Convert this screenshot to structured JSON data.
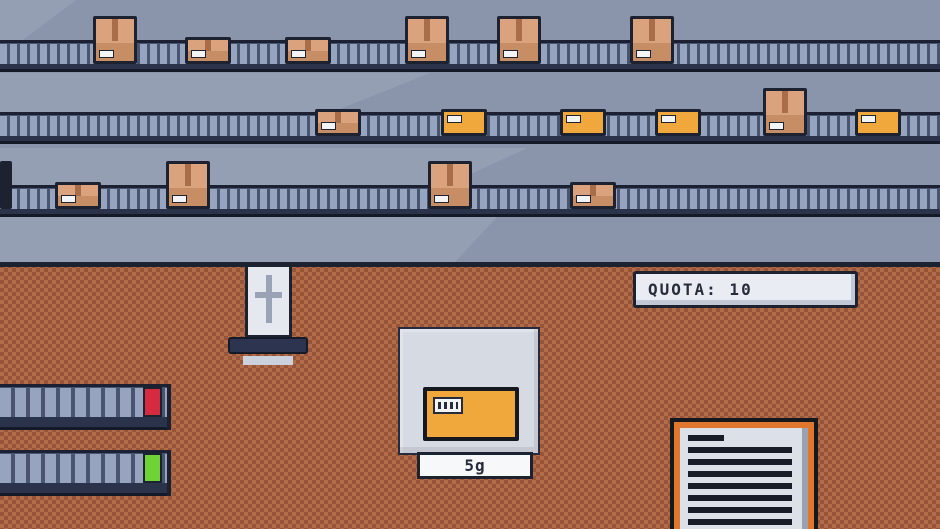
{
  "hud": {
    "quota_sign": {
      "label": "QUOTA: 10"
    },
    "scale_display": {
      "value": "5g"
    }
  },
  "colors": {
    "wall": "#8a95ab",
    "shaft": "rgba(255,255,255,0.10)",
    "outline": "#1d2231",
    "beltSlat": "#97a4bf",
    "beltGap": "#49546e",
    "beltTopLine": "#1b2133",
    "beltBand": "#2a3349",
    "beltBandEdge": "#151a28",
    "floorA": "#b26c47",
    "floorB": "#96553a",
    "boxBrownTop": "#daa37d",
    "boxBrownBottom": "#c78e66",
    "boxTape": "#aa6d4a",
    "boxYellow": "#f0a83c",
    "label": "#f2f4f6",
    "red": "#d62b3e",
    "green": "#6fd335",
    "signBg": "#e9edf3",
    "signShade": "#c2c8d5",
    "signText": "#272c3a",
    "platform": "#d6dae2",
    "platformEdge": "#262c3e",
    "pistonRod": "#e5e9ef",
    "pistonMark": "#9aa3b6",
    "pistonBar": "#2c3450",
    "pistonFoot": "#ccd2dd",
    "clipOrange": "#e0772c",
    "paper": "#dce0e8",
    "paperLine": "#181c28",
    "paperEdge": "#9aa2b2",
    "displayBg": "#f6f8fa",
    "darkBoxEdge": "#15181f"
  },
  "box_types": {
    "tall-brown": {
      "w": 44,
      "h": 48
    },
    "wide-brown": {
      "w": 46,
      "h": 27
    },
    "yellow": {
      "w": 46,
      "h": 27
    },
    "edge-dark": {
      "w": 12,
      "h": 48
    }
  },
  "belts": [
    {
      "name": "conveyor-belt-top",
      "surface_y": 64,
      "boxes": [
        {
          "type": "tall-brown",
          "x": 93
        },
        {
          "type": "wide-brown",
          "x": 185
        },
        {
          "type": "wide-brown",
          "x": 285
        },
        {
          "type": "tall-brown",
          "x": 405
        },
        {
          "type": "tall-brown",
          "x": 497
        },
        {
          "type": "tall-brown",
          "x": 630
        }
      ]
    },
    {
      "name": "conveyor-belt-middle",
      "surface_y": 136,
      "boxes": [
        {
          "type": "wide-brown",
          "x": 315
        },
        {
          "type": "yellow",
          "x": 441
        },
        {
          "type": "yellow",
          "x": 560
        },
        {
          "type": "yellow",
          "x": 655
        },
        {
          "type": "tall-brown",
          "x": 763
        },
        {
          "type": "yellow",
          "x": 855
        }
      ]
    },
    {
      "name": "conveyor-belt-bottom",
      "surface_y": 209,
      "boxes": [
        {
          "type": "edge-dark",
          "x": 0
        },
        {
          "type": "wide-brown",
          "x": 55
        },
        {
          "type": "tall-brown",
          "x": 166
        },
        {
          "type": "tall-brown",
          "x": 428
        },
        {
          "type": "wide-brown",
          "x": 570
        }
      ]
    }
  ],
  "floor_conveyors": [
    {
      "light": "red",
      "y": 384
    },
    {
      "light": "green",
      "y": 450
    }
  ],
  "clipboard": {
    "line_count": 7
  }
}
